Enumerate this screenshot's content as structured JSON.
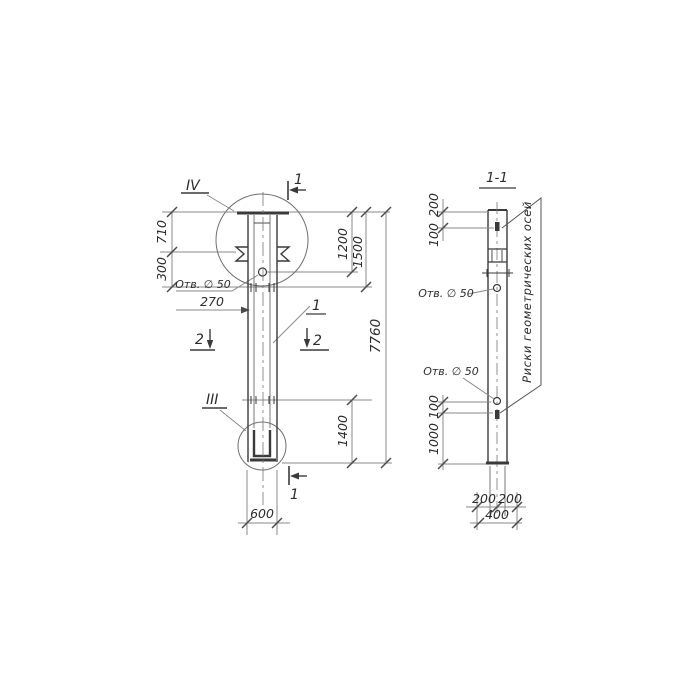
{
  "drawing": {
    "left": {
      "marker_top": "IV",
      "marker_bottom": "III",
      "cut1": "1",
      "cut2": "2",
      "callout": "1",
      "hole_label": "Отв. ∅ 50",
      "dims": {
        "d710": "710",
        "d300": "300",
        "d270": "270",
        "d1200": "1200",
        "d1500": "1500",
        "d7760": "7760",
        "d1400": "1400",
        "d600": "600"
      }
    },
    "right": {
      "title": "1-1",
      "hole_label": "Отв. ∅ 50",
      "axes_note": "Риски геометрических осей",
      "dims": {
        "d200": "200",
        "d100": "100",
        "d1000": "1000",
        "d400": "400"
      }
    },
    "colors": {
      "object_line": "#3a3a3a",
      "dim_line": "#8a8a8a",
      "ink": "#2b2b2b"
    }
  }
}
